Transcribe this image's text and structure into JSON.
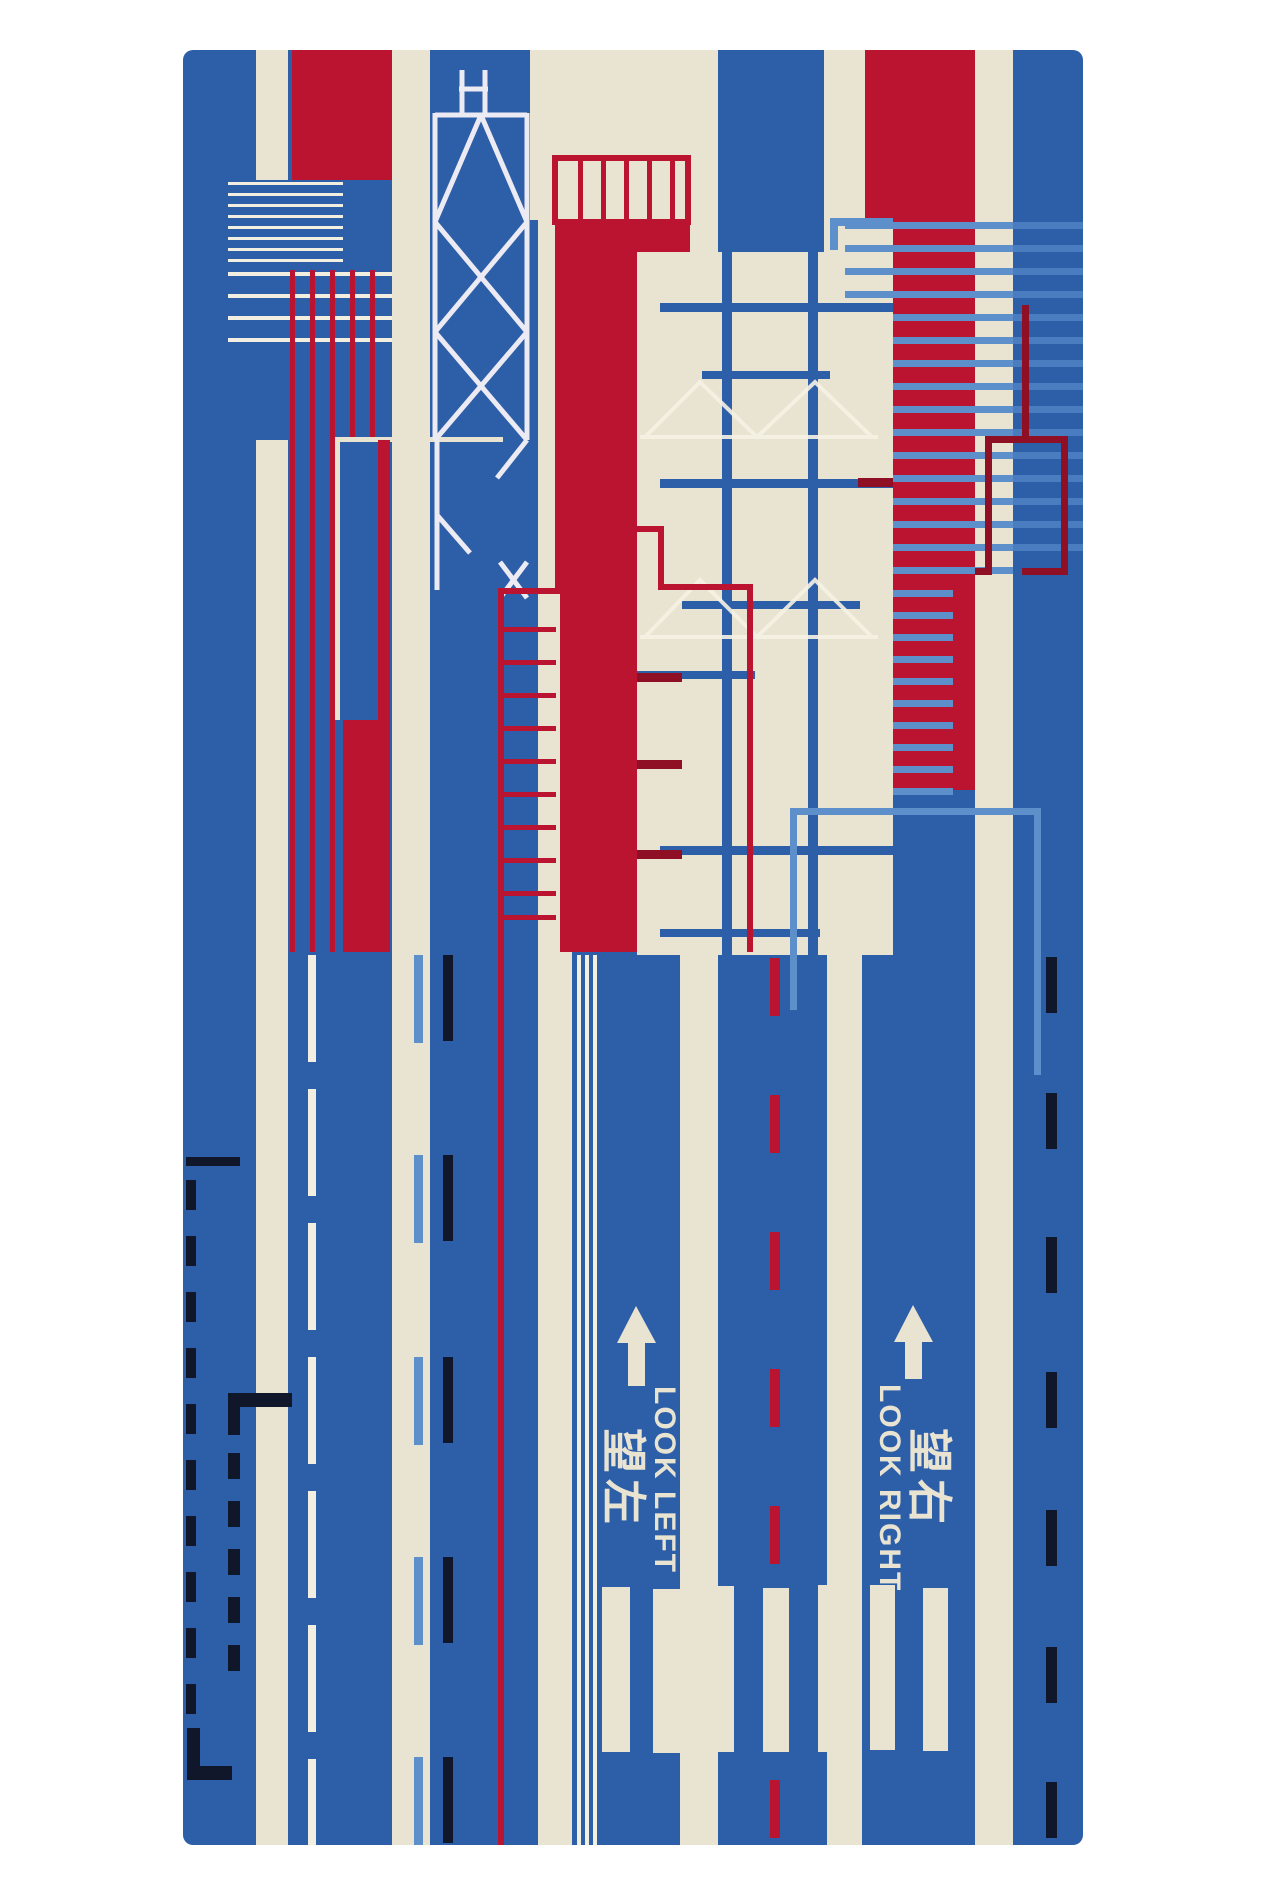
{
  "artwork": {
    "kind": "rug-photograph",
    "background_color": "#ffffff",
    "palette": {
      "blue": "#2d5fa9",
      "cream": "#e9e3d1",
      "red": "#bb1430",
      "dark_red": "#8f1024",
      "light_blue": "#5d8fca",
      "navy_black": "#10172b",
      "white_line": "#f2eee0"
    },
    "motifs": [
      "vertical red-white-blue stripes",
      "bank-of-china-tower outline",
      "building facade grids",
      "louver lines",
      "road lane markings",
      "zebra crossing",
      "direction arrows"
    ],
    "road_markings": {
      "left": {
        "en": "LOOK LEFT",
        "zh": "望左"
      },
      "right": {
        "en": "LOOK RIGHT",
        "zh": "望右"
      }
    }
  }
}
